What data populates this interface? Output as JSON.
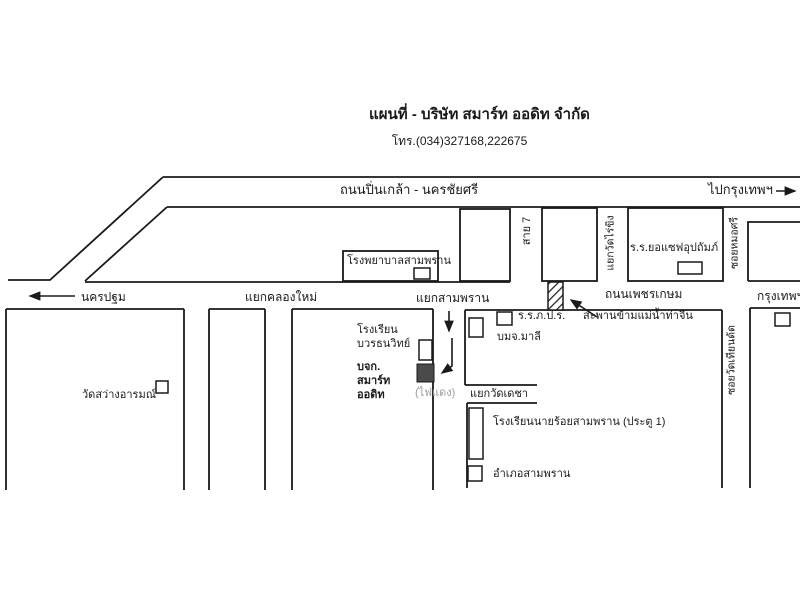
{
  "header": {
    "title": "แผนที่ - บริษัท สมาร์ท ออดิท จำกัด",
    "phone": "โทร.(034)327168,222675"
  },
  "roads": {
    "pinklao": "ถนนปิ่นเกล้า - นครชัยศรี",
    "to_bangkok": "ไปกรุงเทพฯ",
    "phetkasem": "ถนนเพชรเกษม",
    "to_nakhon_pathom": "นครปฐม",
    "bangkok": "กรุงเทพฯ",
    "sai7": "สาย 7",
    "soi_mo_si": "ซอยหมอศรี",
    "soi_wat_thian_dat": "ซอยวัดเทียนดัด"
  },
  "intersections": {
    "klong_mai": "แยกคลองใหม่",
    "sam_phran": "แยกสามพราน",
    "wat_rai_khing": "แยกวัดไร่ขิง",
    "wat_decha": "แยกวัดเดชา"
  },
  "places": {
    "hospital": "โรงพยาบาลสามพราน",
    "yoseph_school": "ร.ร.ยอแซฟอุปถัมภ์",
    "phor_por_ror_school": "ร.ร.ภ.ป.ร.",
    "bridge": "สะพานข้ามแม่น้ำท่าจีน",
    "malee": "บมจ.มาลี",
    "wat_sawang_arom": "วัดสว่างอารมณ์",
    "bovorn_school": "โรงเรียน\nบวรธนวิทย์",
    "company": "บจก.\nสมาร์ท\nออดิท",
    "traffic_light": "(ไฟแดง)",
    "cadet_school": "โรงเรียนนายร้อยสามพราน (ประตู 1)",
    "district_office": "อำเภอสามพราน"
  },
  "colors": {
    "ink": "#1a1a1a",
    "company_fill": "#4a4a4a",
    "muted_text": "#9c9c9c",
    "background": "#ffffff"
  }
}
